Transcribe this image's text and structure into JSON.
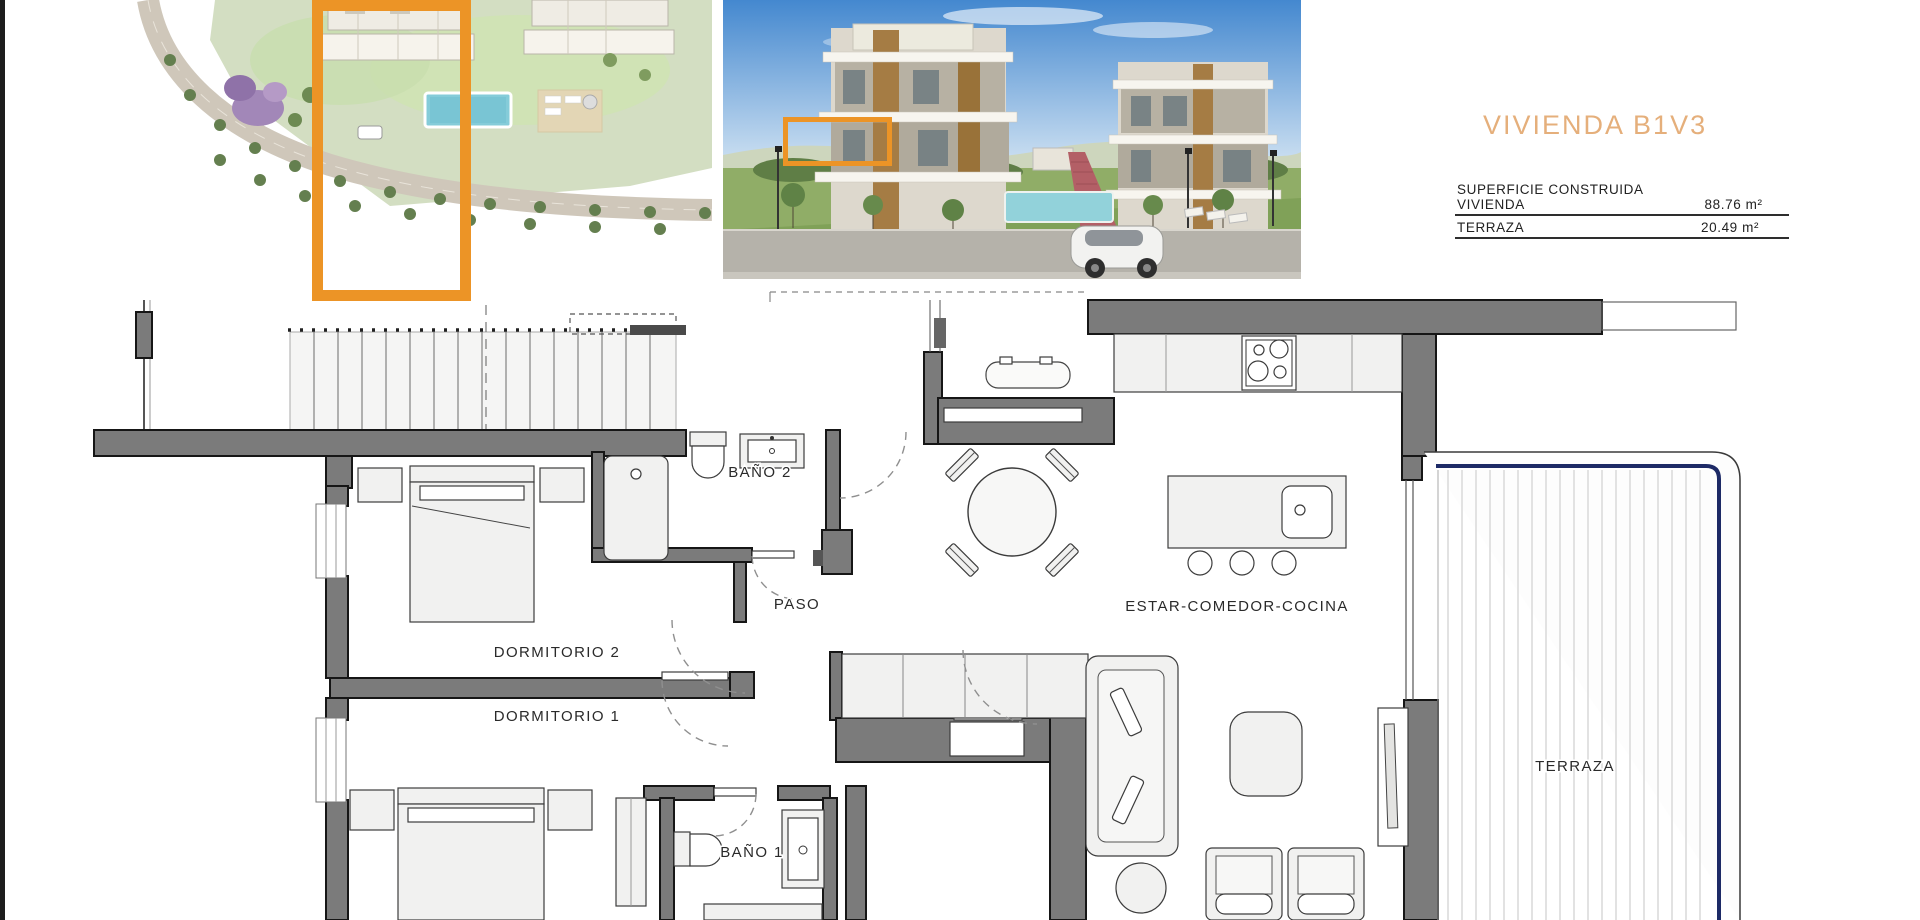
{
  "document": {
    "unit_title": "VIVIENDA B1V3",
    "area_table": {
      "rows": [
        {
          "label": "SUPERFICIE CONSTRUIDA VIVIENDA",
          "value": "88.76 m²"
        },
        {
          "label": "TERRAZA",
          "value": "20.49 m²"
        }
      ]
    }
  },
  "floor_plan": {
    "rooms": [
      {
        "id": "bano-2",
        "label": "BAÑO 2"
      },
      {
        "id": "paso",
        "label": "PASO"
      },
      {
        "id": "dormitorio-2",
        "label": "DORMITORIO 2"
      },
      {
        "id": "dormitorio-1",
        "label": "DORMITORIO 1"
      },
      {
        "id": "bano-1",
        "label": "BAÑO 1"
      },
      {
        "id": "estar-comedor-cocina",
        "label": "ESTAR-COMEDOR-COCINA"
      },
      {
        "id": "terraza",
        "label": "TERRAZA"
      }
    ]
  },
  "colors": {
    "highlight_orange": "#EC9426",
    "title_tan": "#E5AF7B",
    "wall_gray": "#7B7B7B",
    "railing_navy": "#1D2A66"
  }
}
